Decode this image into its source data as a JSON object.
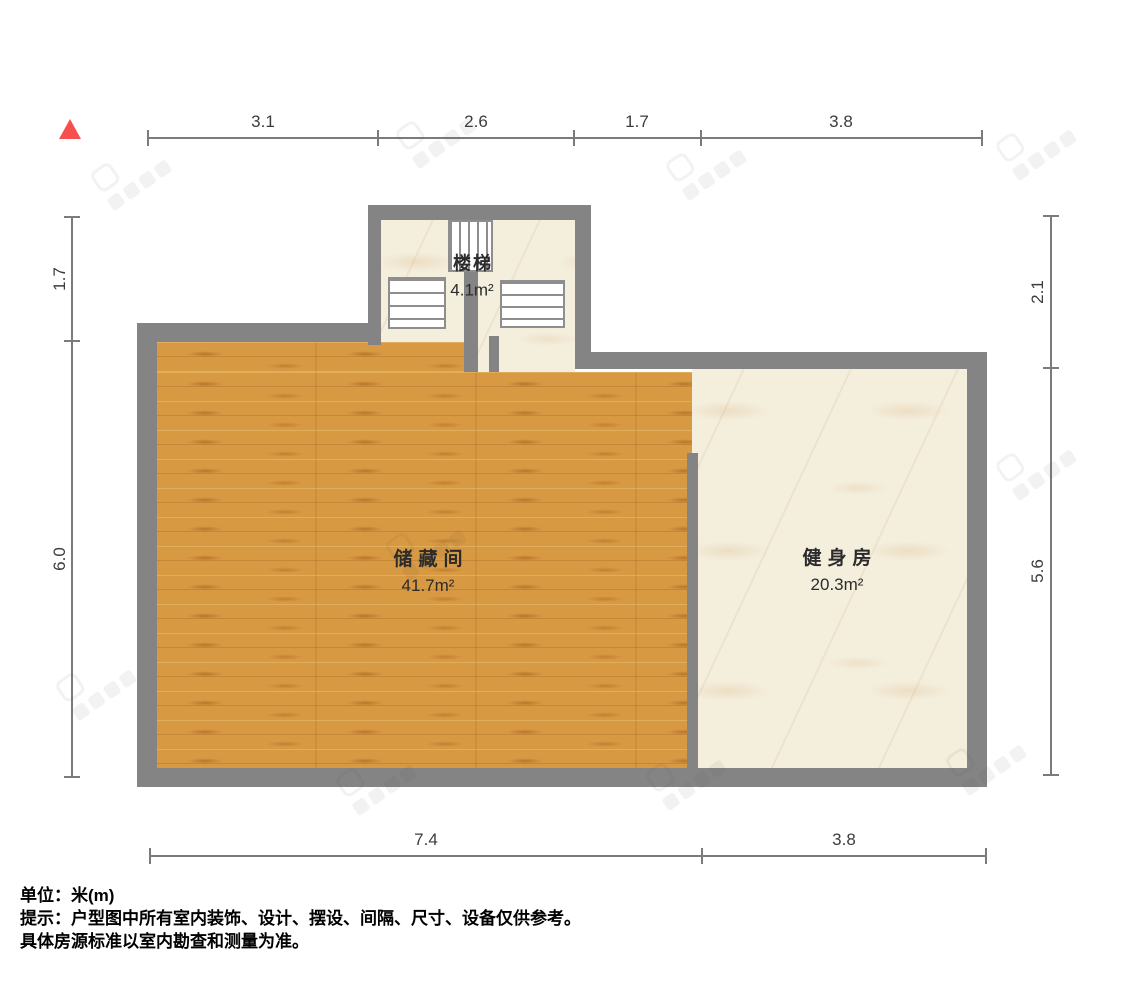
{
  "plan": {
    "unit_label": "米(m)",
    "rooms": [
      {
        "name": "楼梯",
        "area": "4.1m²"
      },
      {
        "name": "储藏间",
        "area": "41.7m²"
      },
      {
        "name": "健身房",
        "area": "20.3m²"
      }
    ]
  },
  "dimensions": {
    "top": [
      "3.1",
      "2.6",
      "1.7",
      "3.8"
    ],
    "bottom": [
      "7.4",
      "3.8"
    ],
    "left": [
      "1.7",
      "6.0"
    ],
    "right": [
      "2.1",
      "5.6"
    ]
  },
  "notes": {
    "unit_line": "单位：米(m)",
    "tip_line1": "提示：户型图中所有室内装饰、设计、摆设、间隔、尺寸、设备仅供参考。",
    "tip_line2": "具体房源标准以室内勘查和测量为准。"
  },
  "colors": {
    "wall": "#848484",
    "dimension": "#7b7b7b",
    "north": "#f6504e",
    "wood_floor": "#d79942",
    "marble_floor": "#f4eedd",
    "label_text": "#2b2b2b"
  }
}
